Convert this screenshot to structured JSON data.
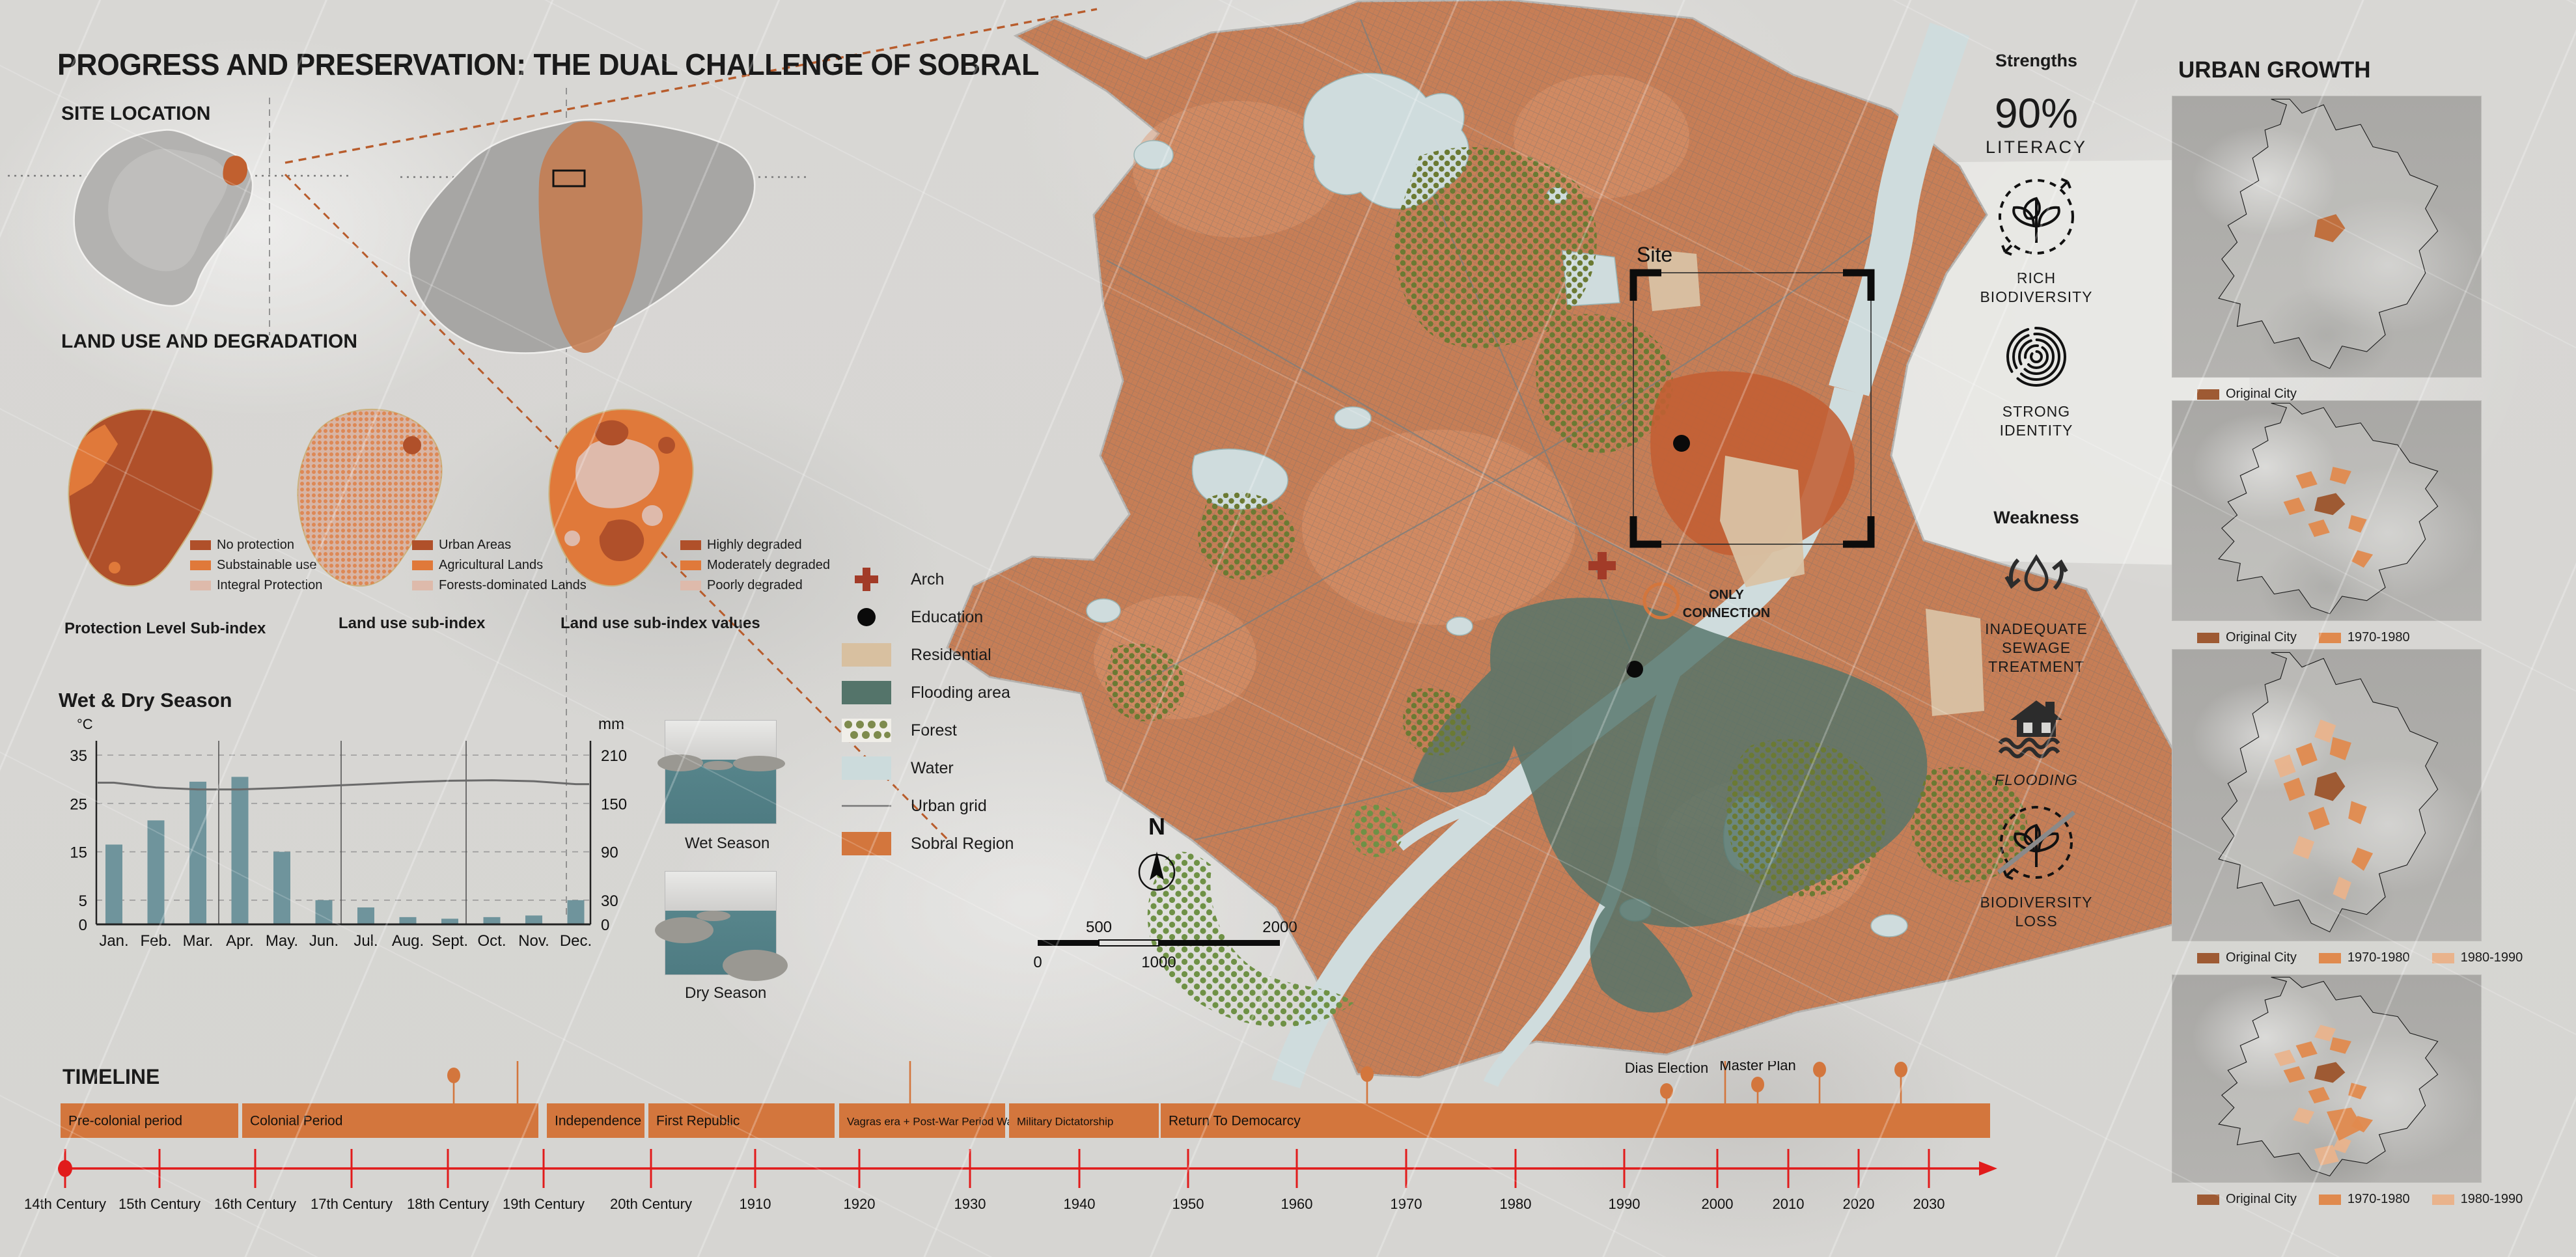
{
  "title": "PROGRESS AND PRESERVATION: THE DUAL CHALLENGE OF SOBRAL",
  "site_location": {
    "heading": "SITE LOCATION"
  },
  "land_use": {
    "heading": "LAND USE AND DEGRADATION",
    "maps": [
      {
        "caption": "Protection Level Sub-index",
        "legend": [
          {
            "label": "No protection",
            "color": "#b0502a"
          },
          {
            "label": "Substainable use",
            "color": "#e0793a"
          },
          {
            "label": "Integral Protection",
            "color": "#debaab"
          }
        ]
      },
      {
        "caption": "Land use sub-index",
        "legend": [
          {
            "label": "Urban Areas",
            "color": "#b0502a"
          },
          {
            "label": "Agricultural Lands",
            "color": "#e0793a"
          },
          {
            "label": "Forests-dominated Lands",
            "color": "#debaab"
          }
        ]
      },
      {
        "caption": "Land use sub-index values",
        "legend": [
          {
            "label": "Highly degraded",
            "color": "#b0502a"
          },
          {
            "label": "Moderately degraded",
            "color": "#e0793a"
          },
          {
            "label": "Poorly degraded",
            "color": "#debaab"
          }
        ]
      }
    ]
  },
  "chart_data": {
    "type": "bar",
    "title": "Wet & Dry Season",
    "unit_left": "°C",
    "unit_right": "mm",
    "categories": [
      "Jan.",
      "Feb.",
      "Mar.",
      "Apr.",
      "May.",
      "Jun.",
      "Jul.",
      "Aug.",
      "Sept.",
      "Oct.",
      "Nov.",
      "Dec."
    ],
    "series": [
      {
        "name": "precipitation_mm",
        "values": [
          99,
          129,
          177,
          183,
          90,
          30,
          21,
          9,
          7,
          9,
          11,
          30
        ]
      },
      {
        "name": "temperature_c",
        "values": [
          29.3,
          28.3,
          27.9,
          27.9,
          28.2,
          28.6,
          29.0,
          29.4,
          29.7,
          29.8,
          29.6,
          29.0
        ]
      }
    ],
    "left_ticks": [
      35,
      25,
      15,
      5,
      0
    ],
    "right_ticks": [
      210,
      150,
      90,
      30,
      0
    ],
    "ylim_left": [
      0,
      35
    ],
    "ylim_right": [
      0,
      210
    ],
    "grid": true,
    "bar_color": "#6f949c",
    "line_color": "#6a6a6a"
  },
  "photos": [
    {
      "caption": "Wet Season"
    },
    {
      "caption": "Dry Season"
    }
  ],
  "map_legend": {
    "items": [
      {
        "label": "Arch",
        "type": "cross",
        "color": "#a23b28"
      },
      {
        "label": "Education",
        "type": "dot",
        "color": "#0a0a0a"
      },
      {
        "label": "Residential",
        "type": "swatch",
        "color": "#d8c0a0"
      },
      {
        "label": "Flooding area",
        "type": "swatch",
        "color": "#54746a"
      },
      {
        "label": "Forest",
        "type": "forest",
        "color": "#6b7a33"
      },
      {
        "label": "Water",
        "type": "swatch",
        "color": "#ccdbdc"
      },
      {
        "label": "Urban grid",
        "type": "line",
        "color": "#777777"
      },
      {
        "label": "Sobral Region",
        "type": "swatch",
        "color": "#d3763d"
      }
    ]
  },
  "main_map": {
    "site_label": "Site",
    "connection_line1": "ONLY",
    "connection_line2": "CONNECTION",
    "north_label": "N",
    "scale_ticks": [
      "0",
      "500",
      "1000",
      "2000"
    ]
  },
  "strengths": {
    "heading": "Strengths",
    "items": [
      {
        "icon": "literacy-stat",
        "value": "90%",
        "label": "LITERACY"
      },
      {
        "icon": "biodiversity-icon",
        "label": "RICH BIODIVERSITY"
      },
      {
        "icon": "fingerprint-icon",
        "label": "STRONG IDENTITY"
      }
    ]
  },
  "weakness": {
    "heading": "Weakness",
    "items": [
      {
        "icon": "water-cycle-icon",
        "label": "INADEQUATE SEWAGE TREATMENT"
      },
      {
        "icon": "flood-house-icon",
        "label": "FLOODING"
      },
      {
        "icon": "biodiversity-loss-icon",
        "label": "BIODIVERSITY LOSS"
      }
    ]
  },
  "urban_growth": {
    "heading": "URBAN GROWTH",
    "legend_colors": {
      "Original City": "#9e5a33",
      "1970-1980": "#e08a4e",
      "1980-1990": "#e9b38c"
    },
    "maps": [
      {
        "legend": [
          "Original City"
        ]
      },
      {
        "legend": [
          "Original City",
          "1970-1980"
        ]
      },
      {
        "legend": [
          "Original City",
          "1970-1980",
          "1980-1990"
        ]
      },
      {
        "legend": [
          "Original City",
          "1970-1980",
          "1980-1990"
        ]
      }
    ]
  },
  "timeline": {
    "heading": "TIMELINE",
    "bar_color": "#d3763d",
    "axis_color": "#e11b1b",
    "periods": [
      {
        "label": "Pre-colonial period",
        "x1": 93,
        "x2": 366
      },
      {
        "label": "Colonial Period",
        "x1": 372,
        "x2": 827
      },
      {
        "label": "Independence",
        "x1": 840,
        "x2": 990
      },
      {
        "label": "First Republic",
        "x1": 996,
        "x2": 1282
      },
      {
        "label": "Vagras era + Post-War Period War",
        "x1": 1289,
        "x2": 1544
      },
      {
        "label": "Military Dictatorship",
        "x1": 1550,
        "x2": 1780
      },
      {
        "label": "Return To Democarcy",
        "x1": 1783,
        "x2": 3057
      }
    ],
    "ticks": [
      {
        "label": "14th Century",
        "x": 100
      },
      {
        "label": "15th Century",
        "x": 245
      },
      {
        "label": "16th Century",
        "x": 392
      },
      {
        "label": "17th Century",
        "x": 540
      },
      {
        "label": "18th Century",
        "x": 688
      },
      {
        "label": "19th Century",
        "x": 835
      },
      {
        "label": "20th Century",
        "x": 1000
      },
      {
        "label": "1910",
        "x": 1160
      },
      {
        "label": "1920",
        "x": 1320
      },
      {
        "label": "1930",
        "x": 1490
      },
      {
        "label": "1940",
        "x": 1658
      },
      {
        "label": "1950",
        "x": 1825
      },
      {
        "label": "1960",
        "x": 1992
      },
      {
        "label": "1970",
        "x": 2160
      },
      {
        "label": "1980",
        "x": 2328
      },
      {
        "label": "1990",
        "x": 2495
      },
      {
        "label": "2000",
        "x": 2638
      },
      {
        "label": "2010",
        "x": 2747
      },
      {
        "label": "2020",
        "x": 2855
      },
      {
        "label": "2030",
        "x": 2963
      }
    ],
    "milestones": [
      {
        "year": "1728",
        "lines": [
          "Igreja da Se de",
          "Sobral"
        ],
        "x": 697,
        "text_top": 1548,
        "dot_y": 1652
      },
      {
        "year": "1742",
        "lines": [
          "Sobral's Foundation"
        ],
        "x": 795,
        "text_top": 1462,
        "dot_y": 1540
      },
      {
        "year": "1925",
        "lines": [
          "Infrastructure",
          "Investment"
        ],
        "x": 1398,
        "text_top": 1505,
        "dot_y": 1608
      },
      {
        "year": "1967",
        "lines": [
          "Urban Development",
          "Masterplan"
        ],
        "x": 2100,
        "text_top": 1548,
        "dot_y": 1650
      },
      {
        "year": "1997",
        "lines": [
          "Francisco Ricardo Barreto",
          "Dias Election"
        ],
        "x": 2560,
        "text_top": 1576,
        "dot_y": 1676
      },
      {
        "year": "2005",
        "lines": [
          "Expansion the urban",
          "planning also for the Districts"
        ],
        "x": 2650,
        "text_top": 1450,
        "dot_y": 1545
      },
      {
        "year": "2008",
        "lines": [
          "Participartory",
          "Master Plan"
        ],
        "x": 2700,
        "text_top": 1572,
        "dot_y": 1666
      },
      {
        "year": "2017",
        "lines": [
          "Urban Perimeter",
          "Reduction Initiative"
        ],
        "x": 2795,
        "text_top": 1540,
        "dot_y": 1643
      },
      {
        "year": "2023",
        "lines": [
          "the airport",
          "closed down"
        ],
        "x": 2920,
        "text_top": 1540,
        "dot_y": 1643
      }
    ]
  },
  "colors": {
    "accent_orange": "#d3763d",
    "region_orange": "#c67a50",
    "dark_rust": "#b0502a",
    "salmon": "#e0793a",
    "pale_rose": "#debaab",
    "flooding_teal": "#54746a",
    "water_blue": "#ccdbdc",
    "residential_tan": "#d8c0a0",
    "forest_olive": "#6b7a33",
    "forest_green": "#6f9146",
    "timeline_red": "#e11b1b"
  }
}
